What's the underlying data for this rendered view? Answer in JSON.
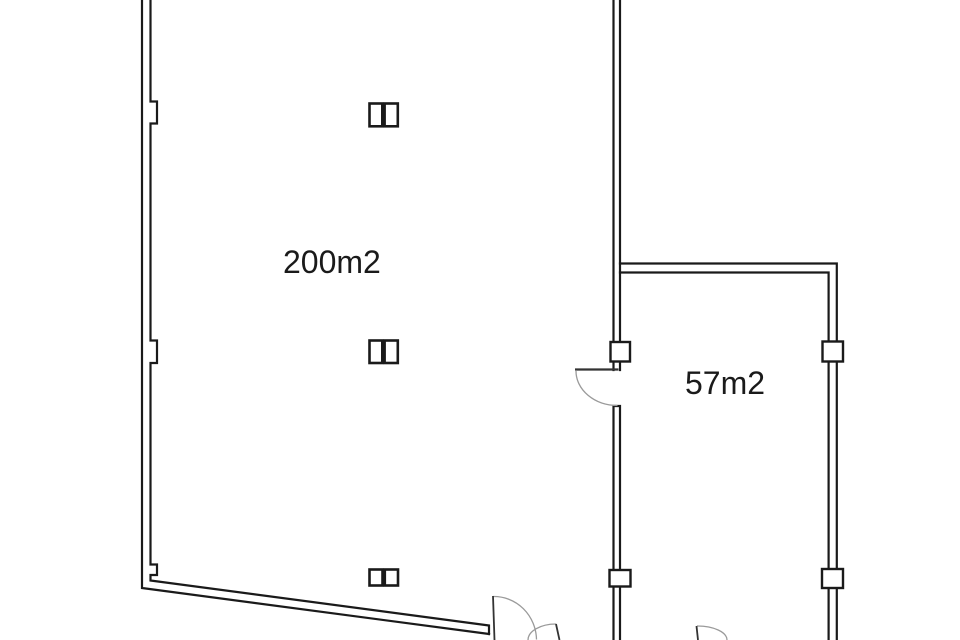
{
  "colors": {
    "background": "#ffffff",
    "wall": "#1a1a1a",
    "door_leaf": "#333333",
    "door_arc": "#9a9a9a",
    "label": "#1a1a1a"
  },
  "rooms": [
    {
      "label": "200m2"
    },
    {
      "label": "57m2"
    }
  ]
}
